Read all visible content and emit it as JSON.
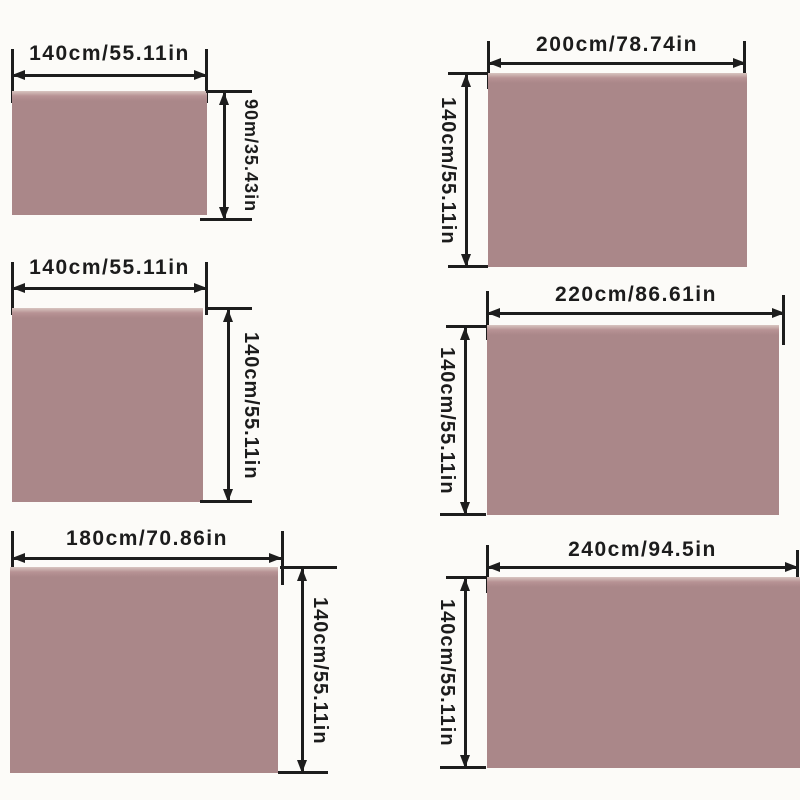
{
  "colors": {
    "swatch_fill": "#aa8789",
    "swatch_top_highlight": "#d8c5c1",
    "line_color": "#1d1d1d",
    "background": "#fcfbf8",
    "text_color": "#1c1c1c"
  },
  "panels": [
    {
      "name": "size-140x90",
      "width_label": "140cm/55.11in",
      "height_label": "90m/35.43in"
    },
    {
      "name": "size-140x140",
      "width_label": "140cm/55.11in",
      "height_label": "140cm/55.11in"
    },
    {
      "name": "size-180x140",
      "width_label": "180cm/70.86in",
      "height_label": "140cm/55.11in"
    },
    {
      "name": "size-200x140",
      "width_label": "200cm/78.74in",
      "height_label": "140cm/55.11in"
    },
    {
      "name": "size-220x140",
      "width_label": "220cm/86.61in",
      "height_label": "140cm/55.11in"
    },
    {
      "name": "size-240x140",
      "width_label": "240cm/94.5in",
      "height_label": "140cm/55.11in"
    }
  ]
}
